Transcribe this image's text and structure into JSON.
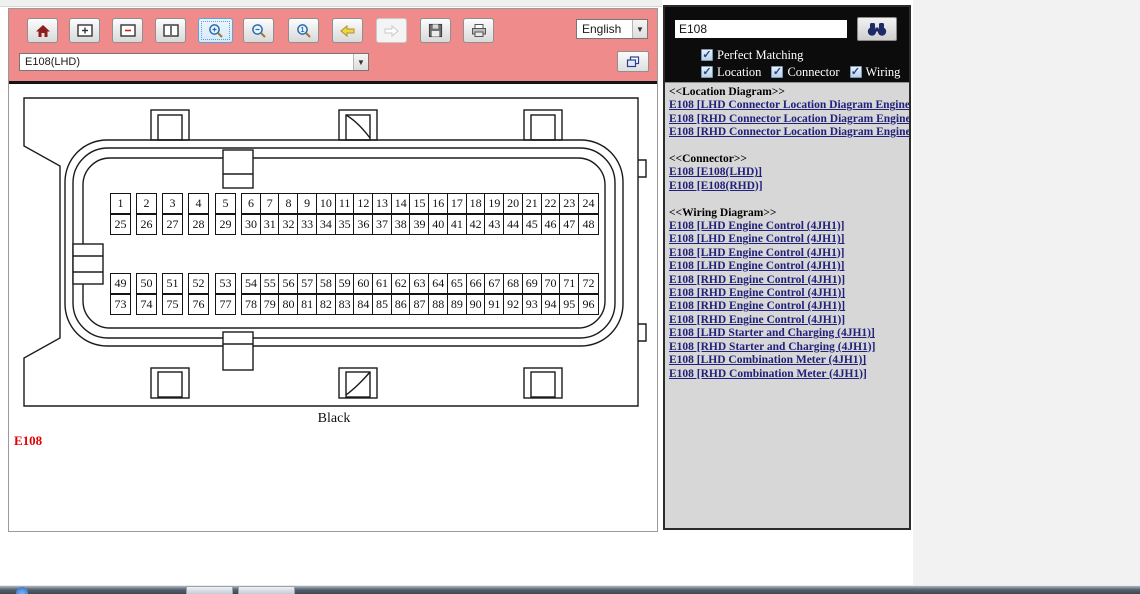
{
  "toolbar": {
    "language": "English",
    "connector_select": "E108(LHD)",
    "buttons": [
      {
        "icon": "home-icon",
        "state": "normal"
      },
      {
        "icon": "window-plus-icon",
        "state": "normal"
      },
      {
        "icon": "window-minus-icon",
        "state": "normal"
      },
      {
        "icon": "window-fit-icon",
        "state": "normal"
      },
      {
        "icon": "zoom-in-icon",
        "state": "selected"
      },
      {
        "icon": "zoom-out-icon",
        "state": "normal"
      },
      {
        "icon": "zoom-actual-icon",
        "state": "normal"
      },
      {
        "icon": "back-icon",
        "state": "normal"
      },
      {
        "icon": "forward-icon",
        "state": "disabled"
      },
      {
        "icon": "save-icon",
        "state": "normal"
      },
      {
        "icon": "print-icon",
        "state": "normal"
      }
    ]
  },
  "search": {
    "query": "E108",
    "search_icon": "binoculars-icon",
    "checkbox_rows": [
      [
        "Perfect Matching"
      ],
      [
        "Location",
        "Connector",
        "Wiring"
      ]
    ],
    "all_checked": true
  },
  "results": {
    "sections": [
      {
        "header": "<<Location Diagram>>",
        "links": [
          "E108 [LHD Connector Location Diagram Engine 4]",
          "E108 [RHD Connector Location Diagram Engine 4]",
          "E108 [RHD Connector Location Diagram Engine 6]"
        ]
      },
      {
        "header": "<<Connector>>",
        "links": [
          "E108 [E108(LHD)]",
          "E108 [E108(RHD)]"
        ]
      },
      {
        "header": "<<Wiring Diagram>>",
        "links": [
          "E108 [LHD Engine Control (4JH1)]",
          "E108 [LHD Engine Control (4JH1)]",
          "E108 [LHD Engine Control (4JH1)]",
          "E108 [LHD Engine Control (4JH1)]",
          "E108 [RHD Engine Control (4JH1)]",
          "E108 [RHD Engine Control (4JH1)]",
          "E108 [RHD Engine Control (4JH1)]",
          "E108 [RHD Engine Control (4JH1)]",
          "E108 [LHD Starter and Charging (4JH1)]",
          "E108 [RHD Starter and Charging (4JH1)]",
          "E108 [LHD Combination Meter (4JH1)]",
          "E108 [RHD Combination Meter (4JH1)]"
        ]
      }
    ]
  },
  "diagram": {
    "connector_id": "E108",
    "label": "Black",
    "pin_rows": [
      [
        1,
        2,
        3,
        4,
        5,
        6,
        7,
        8,
        9,
        10,
        11,
        12,
        13,
        14,
        15,
        16,
        17,
        18,
        19,
        20,
        21,
        22,
        23,
        24
      ],
      [
        25,
        26,
        27,
        28,
        29,
        30,
        31,
        32,
        33,
        34,
        35,
        36,
        37,
        38,
        39,
        40,
        41,
        42,
        43,
        44,
        45,
        46,
        47,
        48
      ],
      [
        49,
        50,
        51,
        52,
        53,
        54,
        55,
        56,
        57,
        58,
        59,
        60,
        61,
        62,
        63,
        64,
        65,
        66,
        67,
        68,
        69,
        70,
        71,
        72
      ],
      [
        73,
        74,
        75,
        76,
        77,
        78,
        79,
        80,
        81,
        82,
        83,
        84,
        85,
        86,
        87,
        88,
        89,
        90,
        91,
        92,
        93,
        94,
        95,
        96
      ]
    ],
    "colors": {
      "accent_salmon": "#ef8b8b",
      "link_blue": "#21217b",
      "id_red": "#e60000"
    }
  },
  "taskbar": {
    "items": [
      "start-orb-icon",
      "window-button",
      "window-button"
    ]
  }
}
